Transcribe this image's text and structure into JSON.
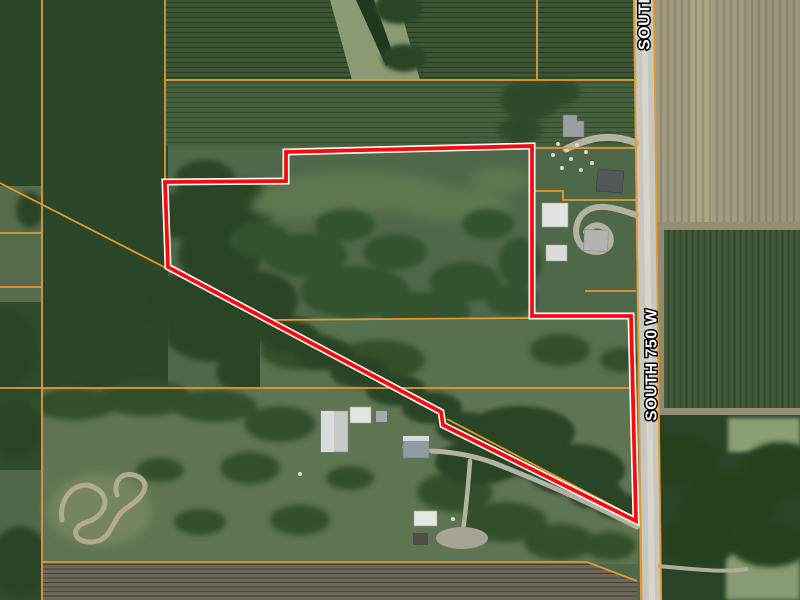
{
  "map": {
    "road_label": "SOUTH 750 W",
    "road_label_top": "SOUTH 750 W",
    "colors": {
      "property_boundary": "#fa0a0a",
      "property_boundary_casing": "#ffffff",
      "parcel_line": "#e5992e",
      "road_surface": "#c8c7be",
      "label_text": "#ffffff",
      "label_outline": "#000000"
    }
  }
}
